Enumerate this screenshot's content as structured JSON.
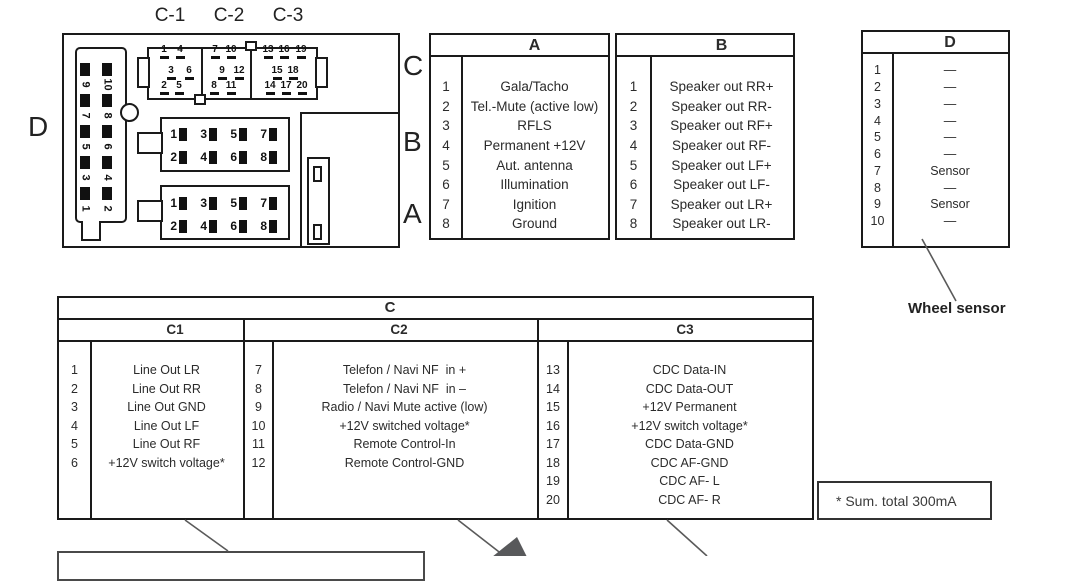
{
  "colors": {
    "border": "#1a1a1a",
    "leader_line": "#5a5a5a",
    "pin": "#111111",
    "triangle": "#58595b"
  },
  "diagram": {
    "c1_label": "C-1",
    "c2_label": "C-2",
    "c3_label": "C-3",
    "c_label": "C",
    "b_label": "B",
    "a_label": "A",
    "d_label": "D",
    "d_pins": [
      {
        "n": "9",
        "x": 76,
        "y": 63
      },
      {
        "n": "10",
        "x": 98,
        "y": 63
      },
      {
        "n": "7",
        "x": 76,
        "y": 94
      },
      {
        "n": "8",
        "x": 98,
        "y": 94
      },
      {
        "n": "5",
        "x": 76,
        "y": 125
      },
      {
        "n": "6",
        "x": 98,
        "y": 125
      },
      {
        "n": "3",
        "x": 76,
        "y": 156
      },
      {
        "n": "4",
        "x": 98,
        "y": 156
      },
      {
        "n": "1",
        "x": 76,
        "y": 187
      },
      {
        "n": "2",
        "x": 98,
        "y": 187
      }
    ],
    "c_pins": [
      {
        "n": "1",
        "x": 156,
        "y": 45
      },
      {
        "n": "4",
        "x": 172,
        "y": 45
      },
      {
        "n": "7",
        "x": 207,
        "y": 45
      },
      {
        "n": "10",
        "x": 223,
        "y": 45
      },
      {
        "n": "13",
        "x": 260,
        "y": 45
      },
      {
        "n": "16",
        "x": 276,
        "y": 45
      },
      {
        "n": "19",
        "x": 293,
        "y": 45
      },
      {
        "n": "3",
        "x": 163,
        "y": 66
      },
      {
        "n": "6",
        "x": 181,
        "y": 66
      },
      {
        "n": "9",
        "x": 214,
        "y": 66
      },
      {
        "n": "12",
        "x": 231,
        "y": 66
      },
      {
        "n": "15",
        "x": 269,
        "y": 66
      },
      {
        "n": "18",
        "x": 285,
        "y": 66
      },
      {
        "n": "2",
        "x": 156,
        "y": 81
      },
      {
        "n": "5",
        "x": 171,
        "y": 81
      },
      {
        "n": "8",
        "x": 206,
        "y": 81
      },
      {
        "n": "11",
        "x": 223,
        "y": 81
      },
      {
        "n": "14",
        "x": 262,
        "y": 81
      },
      {
        "n": "17",
        "x": 278,
        "y": 81
      },
      {
        "n": "20",
        "x": 294,
        "y": 81
      }
    ],
    "b_pins": [
      {
        "n": "1",
        "x": 168,
        "y": 127
      },
      {
        "n": "3",
        "x": 198,
        "y": 127
      },
      {
        "n": "5",
        "x": 228,
        "y": 127
      },
      {
        "n": "7",
        "x": 258,
        "y": 127
      },
      {
        "n": "2",
        "x": 168,
        "y": 150
      },
      {
        "n": "4",
        "x": 198,
        "y": 150
      },
      {
        "n": "6",
        "x": 228,
        "y": 150
      },
      {
        "n": "8",
        "x": 258,
        "y": 150
      }
    ],
    "a_pins": [
      {
        "n": "1",
        "x": 168,
        "y": 196
      },
      {
        "n": "3",
        "x": 198,
        "y": 196
      },
      {
        "n": "5",
        "x": 228,
        "y": 196
      },
      {
        "n": "7",
        "x": 258,
        "y": 196
      },
      {
        "n": "2",
        "x": 168,
        "y": 219
      },
      {
        "n": "4",
        "x": 198,
        "y": 219
      },
      {
        "n": "6",
        "x": 228,
        "y": 219
      },
      {
        "n": "8",
        "x": 258,
        "y": 219
      }
    ]
  },
  "tables": {
    "a": {
      "header": "A",
      "rows": [
        {
          "num": "1",
          "label": "Gala/Tacho"
        },
        {
          "num": "2",
          "label": "Tel.-Mute (active low)"
        },
        {
          "num": "3",
          "label": "RFLS"
        },
        {
          "num": "4",
          "label": "Permanent +12V"
        },
        {
          "num": "5",
          "label": "Aut. antenna"
        },
        {
          "num": "6",
          "label": "Illumination"
        },
        {
          "num": "7",
          "label": "Ignition"
        },
        {
          "num": "8",
          "label": "Ground"
        }
      ]
    },
    "b": {
      "header": "B",
      "rows": [
        {
          "num": "1",
          "label": "Speaker out RR+"
        },
        {
          "num": "2",
          "label": "Speaker out RR-"
        },
        {
          "num": "3",
          "label": "Speaker out RF+"
        },
        {
          "num": "4",
          "label": "Speaker out RF-"
        },
        {
          "num": "5",
          "label": "Speaker out LF+"
        },
        {
          "num": "6",
          "label": "Speaker out LF-"
        },
        {
          "num": "7",
          "label": "Speaker out LR+"
        },
        {
          "num": "8",
          "label": "Speaker out LR-"
        }
      ]
    },
    "d": {
      "header": "D",
      "rows": [
        {
          "num": "1",
          "label": "—"
        },
        {
          "num": "2",
          "label": "—"
        },
        {
          "num": "3",
          "label": "—"
        },
        {
          "num": "4",
          "label": "—"
        },
        {
          "num": "5",
          "label": "—"
        },
        {
          "num": "6",
          "label": "—"
        },
        {
          "num": "7",
          "label": "Sensor"
        },
        {
          "num": "8",
          "label": "—"
        },
        {
          "num": "9",
          "label": "Sensor"
        },
        {
          "num": "10",
          "label": "—"
        }
      ]
    },
    "c": {
      "header": "C",
      "sections": [
        {
          "header": "C1",
          "rows": [
            {
              "num": "1",
              "label": "Line Out LR"
            },
            {
              "num": "2",
              "label": "Line Out RR"
            },
            {
              "num": "3",
              "label": "Line Out GND"
            },
            {
              "num": "4",
              "label": "Line Out LF"
            },
            {
              "num": "5",
              "label": "Line Out RF"
            },
            {
              "num": "6",
              "label": "+12V switch voltage*"
            }
          ]
        },
        {
          "header": "C2",
          "rows": [
            {
              "num": "7",
              "label": "Telefon / Navi NF  in +"
            },
            {
              "num": "8",
              "label": "Telefon / Navi NF  in –"
            },
            {
              "num": "9",
              "label": "Radio / Navi Mute active (low)"
            },
            {
              "num": "10",
              "label": "+12V switched voltage*"
            },
            {
              "num": "11",
              "label": "Remote Control-In"
            },
            {
              "num": "12",
              "label": "Remote Control-GND"
            }
          ]
        },
        {
          "header": "C3",
          "rows": [
            {
              "num": "13",
              "label": "CDC Data-IN"
            },
            {
              "num": "14",
              "label": "CDC Data-OUT"
            },
            {
              "num": "15",
              "label": "+12V Permanent"
            },
            {
              "num": "16",
              "label": "+12V switch voltage*"
            },
            {
              "num": "17",
              "label": "CDC Data-GND"
            },
            {
              "num": "18",
              "label": "CDC AF-GND"
            },
            {
              "num": "19",
              "label": "CDC AF- L"
            },
            {
              "num": "20",
              "label": "CDC AF- R"
            }
          ]
        }
      ]
    }
  },
  "annotations": {
    "wheel_sensor": "Wheel sensor",
    "note": "* Sum. total 300mA"
  }
}
